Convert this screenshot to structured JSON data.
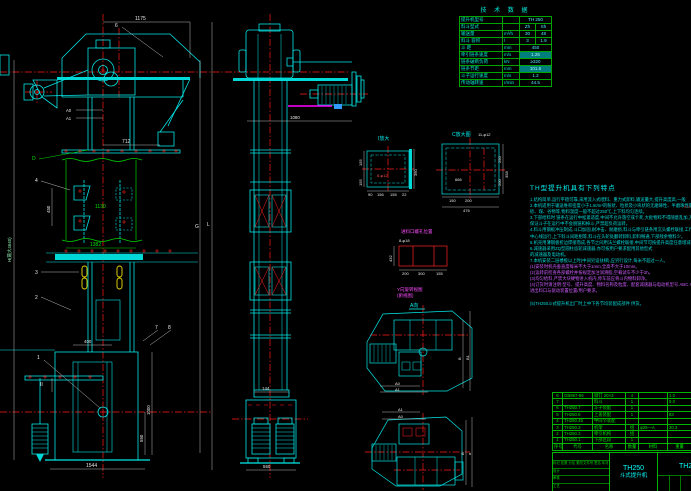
{
  "tech_table": {
    "title": "技 术 数 据",
    "rows": [
      {
        "label": "提升机型号",
        "unit": "",
        "v1": "TH 250",
        "v2": ""
      },
      {
        "label": "料斗型式",
        "unit": "",
        "v1": "Zh",
        "v2": "Sh"
      },
      {
        "label": "输送量",
        "unit": "m³/h",
        "v1": "30",
        "v2": "48"
      },
      {
        "label": "料斗 容积",
        "unit": "l",
        "v1": "3",
        "v2": "1.9"
      },
      {
        "label": "斗  距",
        "unit": "mm",
        "v1": "450",
        "v2": ""
      },
      {
        "label": "牵引链条速度",
        "unit": "m/s",
        "v1": "1.25",
        "v2": ""
      },
      {
        "label": "链条破断负荷",
        "unit": "kN",
        "v1": "≥320",
        "v2": ""
      },
      {
        "label": "链条节距",
        "unit": "mm",
        "v1": "101.6",
        "v2": ""
      },
      {
        "label": "斗子运行速度",
        "unit": "m/s",
        "v1": "1.2",
        "v2": ""
      },
      {
        "label": "传动轴转速",
        "unit": "r/min",
        "v1": "44.5",
        "v2": ""
      }
    ]
  },
  "notes": {
    "title": "TH型提升机具有下列特点",
    "lines": [
      "1.结构简单,运行平稳可靠,采用流入式喂料、重力式卸料,输送量大,提升高度高,一般",
      "2.本机适用于输送堆积密度小于1.5t/m³的粉状、粒状及小块状的无磨琢性、半磨琢性散状物料,如水泥、",
      "  砂、煤、谷物等,物料温度一般不超过250℃,上下料均匀连续。",
      "3.下部给料时 链条在运行中松紧适度,中间不允许落空或卡死,大批物料不得随意乱加,方可",
      "  保证斗子在运行中不会脱链和掉斗,严禁超负荷运转。",
      "4.料斗用钢板冲压制成,斗口加固,耐冲击、耐磨损,料斗与牵引链条用沉头螺栓联接,工作时料斗沿机壳",
      "  中心线运行,上下料斗间距相等,料斗在头轮处翻转卸料,卸料畅通,下部残余物料少。",
      "5.机壳用薄钢板折边焊接而成,各节之间用法兰螺栓联接,中间节可按提升高度任意增减,密封性能好。",
      "6.减速器采用ZQ型圆柱齿轮减速器,亦可按用户要求配用其他型式",
      "  的减速器及电动机。",
      "7.本机安装二层楼板以上时(中间另设扶梯),应另行设计,每米不超过一人。",
      "(1)安装时机壳垂直度每米不大于1mm,全高不大于10mm。",
      "(2)运转前检查各部螺栓并按规定加注润滑脂,空载试车不少于2h。",
      "(3)均匀给料,严禁大块硬物进入机内,停车前应将斗内物料卸净。",
      "(4)订货时请注明:型号、提升高度、物料名称及粒度、配套减速器与电动机型号 ABC.Y系列,",
      "  进出料口与驱动装置位置/用户要求。",
      "(5)TH250斗式提升机出厂时上中下各节均装配成部件 供货。"
    ]
  },
  "bom": {
    "headers": [
      "序号",
      "代号",
      "名称",
      "数量",
      "材料",
      "重量"
    ],
    "rows": [
      {
        "no": "8",
        "code": "GB867-86",
        "name": "铆钉 20×3",
        "qty": "4",
        "mat": "",
        "wt": "1.0"
      },
      {
        "no": "7",
        "code": "",
        "name": "料斗",
        "qty": "1",
        "mat": "",
        "wt": "9.0"
      },
      {
        "no": "6",
        "code": "TH250.7",
        "name": "斗子装配",
        "qty": "1",
        "mat": "",
        "wt": ""
      },
      {
        "no": "5",
        "code": "TH250.6",
        "name": "上盖装配",
        "qty": "1",
        "mat": "",
        "wt": "83"
      },
      {
        "no": "4",
        "code": "TH250.45",
        "name": "中间节装配",
        "qty": "",
        "mat": "",
        "wt": ""
      },
      {
        "no": "3",
        "code": "TH250.3",
        "name": "机架",
        "qty": "组",
        "mat": "φ25—A",
        "wt": "20.3"
      },
      {
        "no": "2",
        "code": "TH250.2",
        "name": "牵引机构",
        "qty": "组",
        "mat": "",
        "wt": ""
      },
      {
        "no": "1",
        "code": "TH250.1",
        "name": "下部区段",
        "qty": "1",
        "mat": "",
        "wt": ""
      }
    ]
  },
  "title_block": {
    "model": "TH250",
    "product": "斗式提升机",
    "drawing_no": "TH2",
    "rev_line": "标记 处数 分区 更改文件号 签名 年月日",
    "sig_design": "设计",
    "sig_check": "审核",
    "sig_craft": "工艺"
  },
  "dims": {
    "f1175": "1175",
    "f712": "712",
    "fA0": "A0",
    "fA1": "A1",
    "fG": "G",
    "fL": "L",
    "fH": "H(最大4640)",
    "f450": "450",
    "f1130": "1130",
    "f1382": "1382",
    "f400": "400",
    "f1000": "1000",
    "f550": "550",
    "f1544": "1544",
    "fII": "II",
    "fD": "D",
    "s144": "144",
    "s550": "550",
    "s1080": "1080"
  },
  "balloons": {
    "b1": "1",
    "b2": "2",
    "b3": "3",
    "b4": "4",
    "b6": "6",
    "b7": "7",
    "b8": "8"
  },
  "details": {
    "i_title": "I放大",
    "i_bolt": "8-φ12",
    "i_155a": "155",
    "i_155b": "155",
    "i_360": "360",
    "i_90": "90",
    "i_156": "156",
    "i_155c": "155",
    "i_22": "22",
    "c_title": "C放大图",
    "c_bolt": "11-φ12",
    "c_666": "666",
    "c_250": "250",
    "c_200a": "200",
    "c_150": "150",
    "c_200b": "200",
    "c_476": "476",
    "c_358": "358",
    "in_title": "进料口螺孔位置",
    "in_bolt": "8-φ18",
    "in_432": "432",
    "in_200": "200",
    "in_300": "300",
    "in_155": "155",
    "pa_l1": "Y向旋转视图",
    "pa_l2": "(俯视图)",
    "pa_av": "A向",
    "pa_b": "B",
    "pa_b1": "B1",
    "pa_a0": "A0",
    "pa_a1": "A1",
    "pb_a1": "A1",
    "pb_a0": "A0",
    "pb_b": "B",
    "pb_a": "a"
  }
}
